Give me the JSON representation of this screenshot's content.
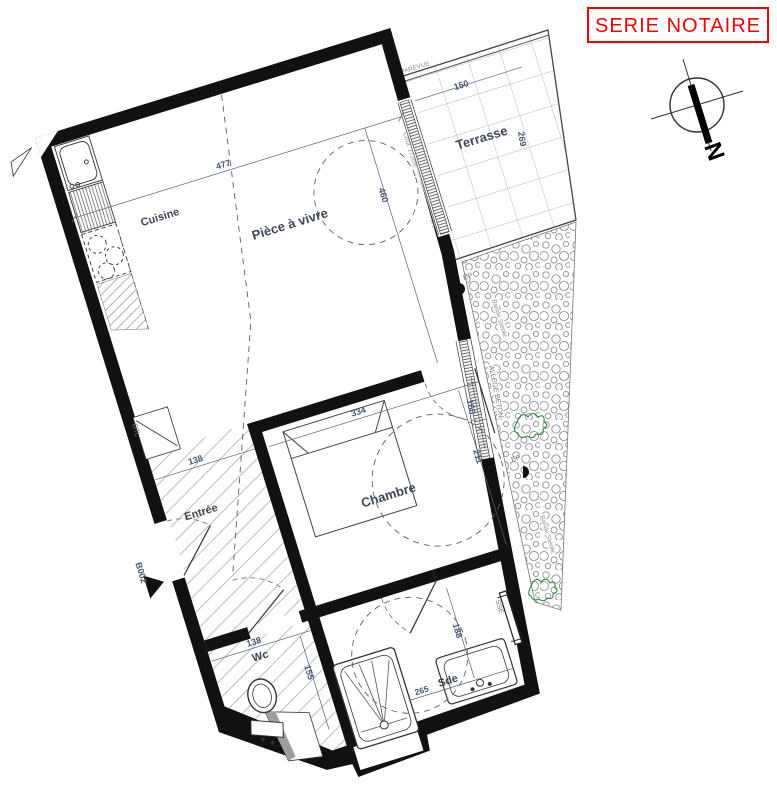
{
  "stamp": {
    "label": "SERIE NOTAIRE",
    "color": "#f40000"
  },
  "compass": {
    "north_label": "N"
  },
  "rooms": {
    "terrace": {
      "name": "Terrasse",
      "width": "150",
      "depth": "269"
    },
    "kitchen": {
      "name": "Cuisine"
    },
    "living": {
      "name": "Pièce à vivre",
      "width": "477",
      "depth": "460"
    },
    "bedroom": {
      "name": "Chambre",
      "width": "334",
      "window": "160",
      "depth": "211"
    },
    "entry": {
      "name": "Entrée",
      "width": "138"
    },
    "wc": {
      "name": "Wc",
      "width": "138",
      "depth": "155"
    },
    "shower_room": {
      "name": "Sde",
      "width": "265",
      "depth": "188"
    }
  },
  "annotations": {
    "parevue": "PAREVUE",
    "ep_top": "EP",
    "ep_bottom": "EP",
    "bande_sterile_top": "Bande Stérile",
    "bande_sterile_bottom": "Bande Stérile",
    "allege_beton": "ALLEGE BETON",
    "bedroom_window": "OUV 140",
    "bay_window": "Coul. 172cm",
    "bay_shutter": "VR",
    "gtl": "GTL",
    "entry_door_ref": "B002",
    "towel_rail": "SSE"
  }
}
